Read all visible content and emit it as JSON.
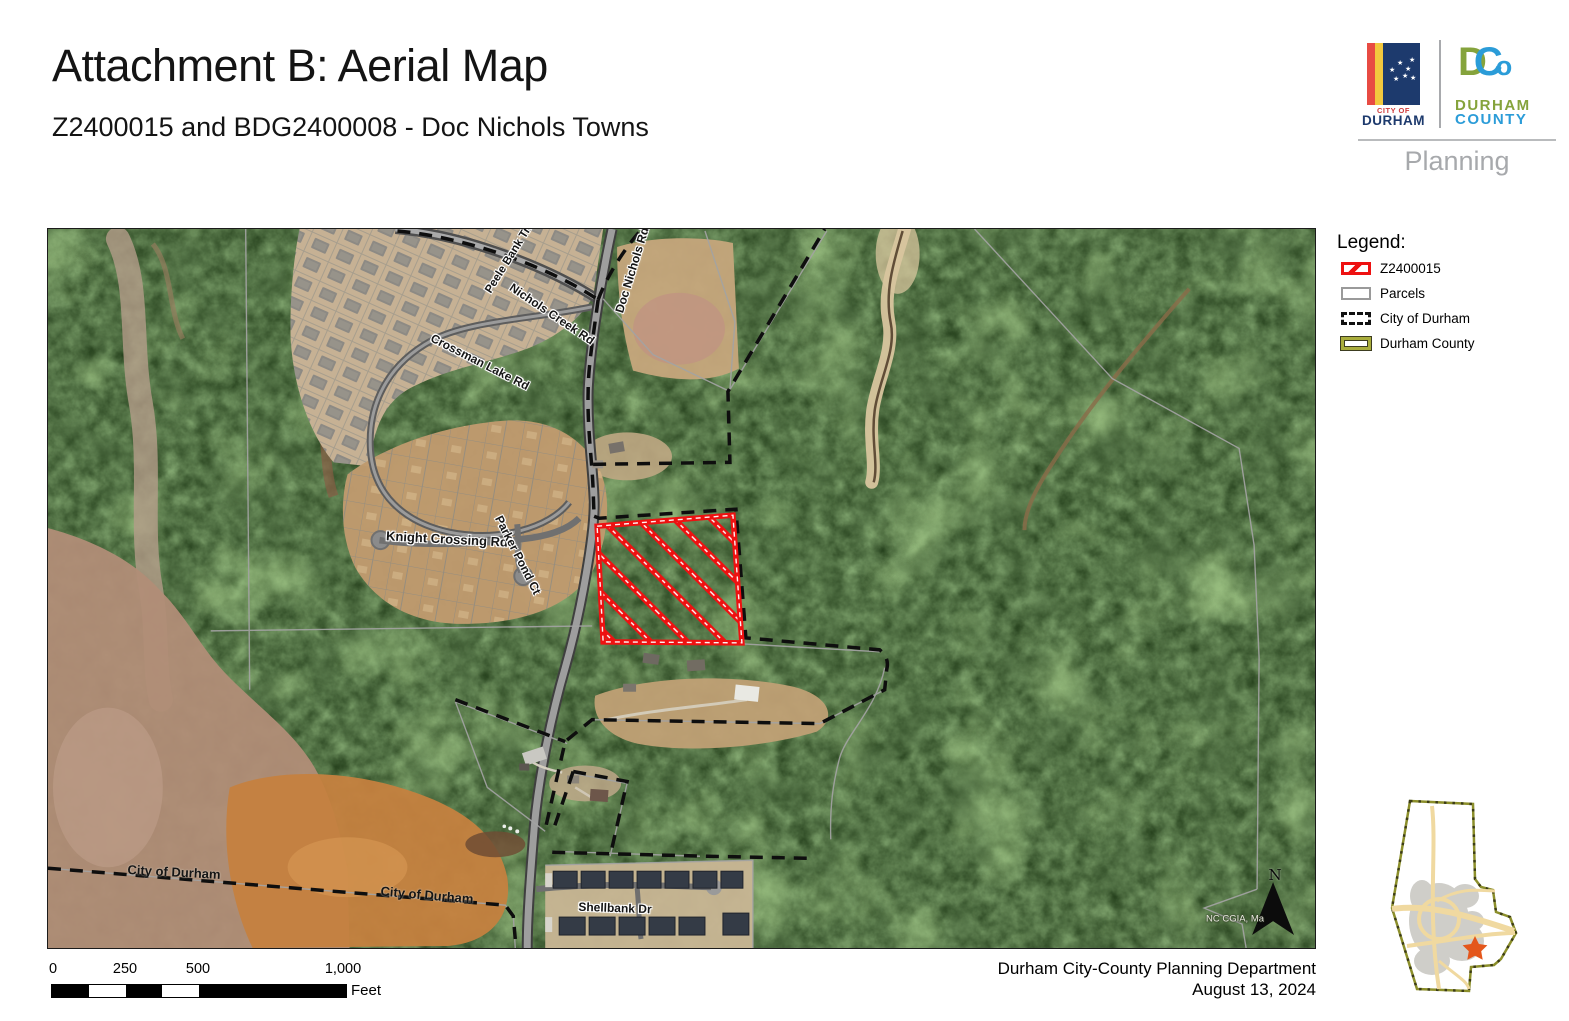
{
  "page": {
    "title": "Attachment B: Aerial Map",
    "subtitle": "Z2400015 and BDG2400008 - Doc Nichols Towns"
  },
  "branding": {
    "city_top": "CITY OF",
    "city_name": "DURHAM",
    "dco_d": "D",
    "dco_c": "C",
    "dco_o": "o",
    "county_line1": "DURHAM",
    "county_line2": "COUNTY",
    "department": "Planning"
  },
  "legend": {
    "title": "Legend:",
    "items": [
      {
        "label": "Z2400015",
        "swatch": "red-hatched-outline"
      },
      {
        "label": "Parcels",
        "swatch": "gray-outline"
      },
      {
        "label": "City of Durham",
        "swatch": "black-dashed-outline"
      },
      {
        "label": "Durham County",
        "swatch": "olive-outline"
      }
    ]
  },
  "map": {
    "labels": [
      {
        "text": "Peele Bank Trl",
        "type": "road"
      },
      {
        "text": "Nichols Creek Rd",
        "type": "road"
      },
      {
        "text": "Doc Nichols Rd",
        "type": "road"
      },
      {
        "text": "Crossman Lake Rd",
        "type": "road"
      },
      {
        "text": "Knight Crossing Rd",
        "type": "road"
      },
      {
        "text": "Parker Pond Ct",
        "type": "road"
      },
      {
        "text": "Shellbank Dr",
        "type": "road"
      },
      {
        "text": "City of Durham",
        "type": "boundary"
      },
      {
        "text": "City of Durham",
        "type": "boundary"
      }
    ],
    "attribution": "NC CGIA, Ma",
    "north_label": "N",
    "subject_parcel": "Z2400015"
  },
  "scale_bar": {
    "ticks": [
      "0",
      "250",
      "500",
      "1,000"
    ],
    "unit": "Feet"
  },
  "footer": {
    "line1": "Durham City-County Planning Department",
    "line2": "August 13, 2024"
  },
  "colors": {
    "subject_red": "#ee1111",
    "city_boundary": "#0e0e0e",
    "parcel_line": "#a3a3a3",
    "county_olive": "#a9ad3c",
    "city_navy": "#1d3a6d",
    "city_red": "#e84b43",
    "city_yellow": "#f2c83e",
    "county_green": "#85a33c",
    "county_blue": "#2b9cd8",
    "planning_gray": "#a7a9ac"
  }
}
